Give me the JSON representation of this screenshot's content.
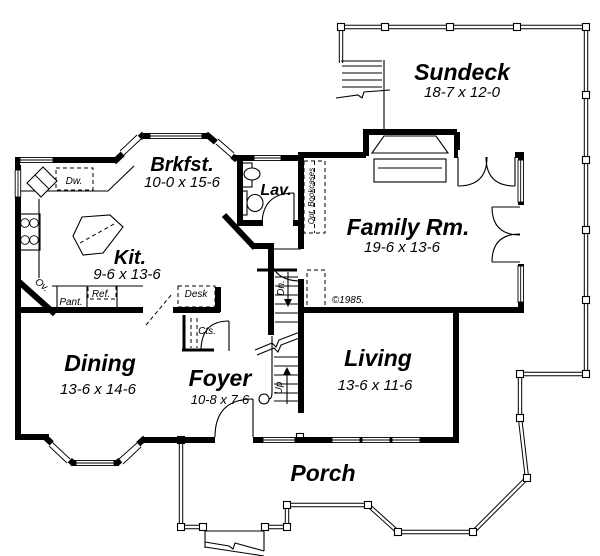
{
  "plan": {
    "rooms": {
      "sundeck": {
        "name": "Sundeck",
        "dims": "18-7 x 12-0"
      },
      "brkfst": {
        "name": "Brkfst.",
        "dims": "10-0 x 15-6"
      },
      "lav": {
        "name": "Lav."
      },
      "family": {
        "name": "Family Rm.",
        "dims": "19-6 x 13-6"
      },
      "kitchen": {
        "name": "Kit.",
        "dims": "9-6 x 13-6"
      },
      "dining": {
        "name": "Dining",
        "dims": "13-6 x 14-6"
      },
      "foyer": {
        "name": "Foyer",
        "dims": "10-8 x 7-6"
      },
      "living": {
        "name": "Living",
        "dims": "13-6 x 11-6"
      },
      "porch": {
        "name": "Porch"
      }
    },
    "labels": {
      "dishwasher": "Dw.",
      "oven": "Ov.",
      "pantry": "Pant.",
      "refrigerator": "Ref.",
      "desk": "Desk",
      "closets": "Cts.",
      "stairs_down": "Dn.",
      "stairs_up": "Up",
      "bookcases": "Opt. Bookcases",
      "copyright": "©1985."
    },
    "colors": {
      "wall": "#000000",
      "paper": "#ffffff"
    }
  }
}
